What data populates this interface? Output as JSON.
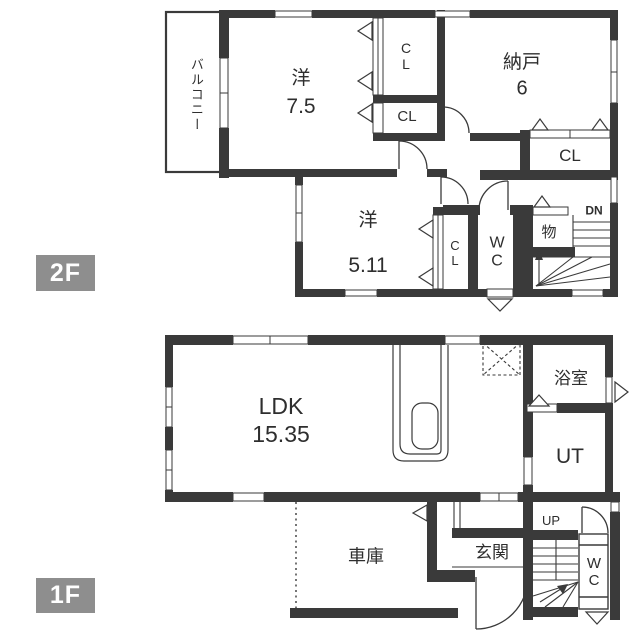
{
  "colors": {
    "wall": "#3a3a3a",
    "floor_tag_bg": "#8e8e8e",
    "floor_tag_text": "#ffffff",
    "paper": "#ffffff"
  },
  "floor2": {
    "tag": "2F",
    "balcony": "バルコニー",
    "room_west_large": {
      "name": "洋",
      "size": "7.5"
    },
    "closet_top": {
      "l1": "C",
      "l2": "L"
    },
    "closet_mid": "CL",
    "storage_room": {
      "name": "納戸",
      "size": "6"
    },
    "closet_right": "CL",
    "room_west_small": {
      "name": "洋",
      "size": "5.11"
    },
    "closet_small": {
      "l1": "C",
      "l2": "L"
    },
    "toilet": {
      "l1": "W",
      "l2": "C"
    },
    "storage_small": "物",
    "stairs_down": "DN"
  },
  "floor1": {
    "tag": "1F",
    "ldk": {
      "name": "LDK",
      "size": "15.35"
    },
    "bathroom": "浴室",
    "utility": "UT",
    "garage": "車庫",
    "entrance": "玄関",
    "stairs_up": "UP",
    "toilet": {
      "l1": "W",
      "l2": "C"
    }
  }
}
